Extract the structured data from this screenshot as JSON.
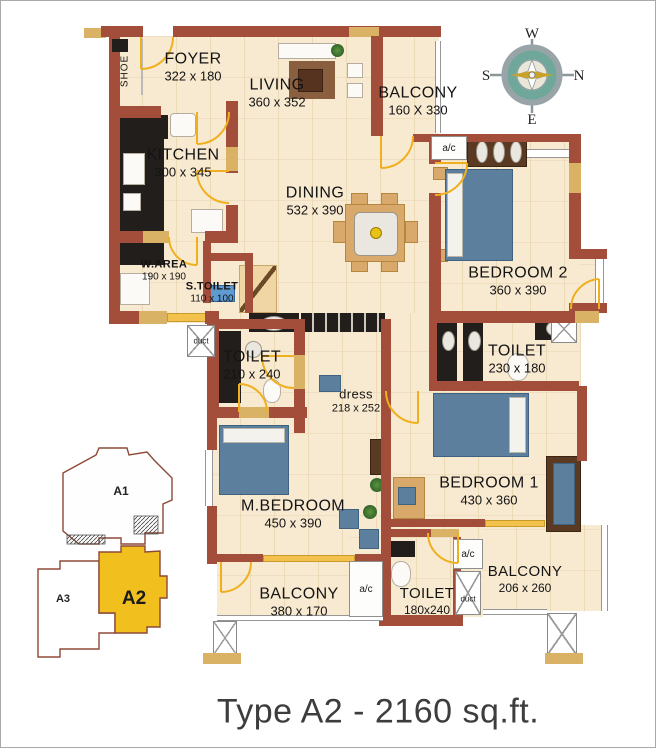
{
  "title": "Type A2 - 2160 sq.ft.",
  "compass": {
    "top": "W",
    "bottom": "E",
    "left": "S",
    "right": "N"
  },
  "keyplan": {
    "a1": "A1",
    "a2": "A2",
    "a3": "A3"
  },
  "rooms": {
    "foyer": {
      "name": "FOYER",
      "dims": "322 x 180"
    },
    "living": {
      "name": "LIVING",
      "dims": "360 x 352"
    },
    "balcony_top": {
      "name": "BALCONY",
      "dims": "160 X 330"
    },
    "kitchen": {
      "name": "KITCHEN",
      "dims": "300 x 345"
    },
    "dining": {
      "name": "DINING",
      "dims": "532 x 390"
    },
    "bedroom2": {
      "name": "BEDROOM 2",
      "dims": "360 x 390"
    },
    "warea": {
      "name": "W.AREA",
      "dims": "190 x 190"
    },
    "stoilet": {
      "name": "S.TOILET",
      "dims": "110 x 100"
    },
    "toilet_ml": {
      "name": "TOILET",
      "dims": "210 x 240"
    },
    "toilet_mr": {
      "name": "TOILET",
      "dims": "230 x 180"
    },
    "dress": {
      "name": "dress",
      "dims": "218 x 252"
    },
    "mbedroom": {
      "name": "M.BEDROOM",
      "dims": "450 x 390"
    },
    "bedroom1": {
      "name": "BEDROOM 1",
      "dims": "430 x 360"
    },
    "balcony_bottom": {
      "name": "BALCONY",
      "dims": "380 x 170"
    },
    "toilet_bottom": {
      "name": "TOILET",
      "dims": "180x240"
    },
    "balcony_right": {
      "name": "BALCONY",
      "dims": "206 x 260"
    }
  },
  "labels": {
    "shoe": "SHOE",
    "duct": "duct",
    "ac": "a/c"
  },
  "colors": {
    "wall": "#a24e3a",
    "lintel": "#d9b266",
    "floor": "#f8e9d1",
    "door": "#f0b01e",
    "highlight": "#f2c01e",
    "bed": "#5d7f9e"
  }
}
